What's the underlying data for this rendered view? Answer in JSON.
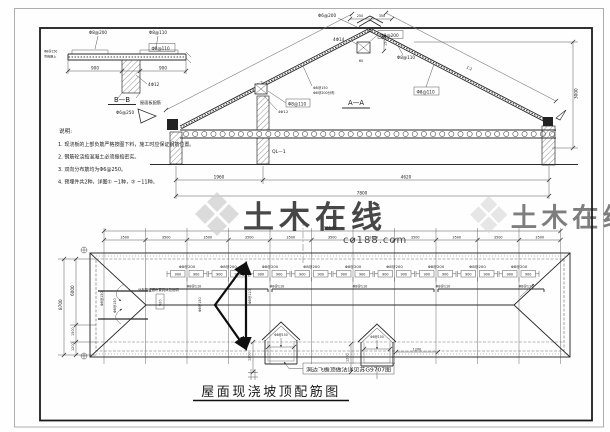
{
  "watermark": {
    "brand": "土木在线",
    "site": "co188.com"
  },
  "detail_bb": {
    "label_top_left": "Φ8@200",
    "label_top_right": "Φ8@110",
    "label_boxed": "Φ8@110",
    "label_left_1": "Φ8@150",
    "label_left_2": "弯钩朝上",
    "label_beam": "4Φ12",
    "dim_left": "900",
    "dim_right": "900",
    "title": "B—B",
    "subtitle": "屋面板配筋"
  },
  "notes": {
    "heading": "说明:",
    "items": [
      "1. 现浇板的上部负筋严格按图下料，施工时应保证钢筋位置。",
      "2. 钢筋砼浇捣混凝土必须振捣密实。",
      "3. 双向分布筋均为Φ6@250。",
      "4. 预埋件共2种，详图① ~1种，② ~11种。"
    ]
  },
  "section": {
    "title": "A—A",
    "ridge_stirrup": "Φ6@200",
    "ridge_main": "4Φ14",
    "ridge_boxed": "Φ8@200",
    "ridge_dim_a": "250",
    "ridge_dim_b": "350",
    "ridge_dim_v": "150",
    "ridge_dim_w": "60",
    "slope_left_1": "Φ8@150",
    "slope_left_2": "Φ6@200分布",
    "slope_right": "Φ8@110",
    "slope_right_boxed": "Φ8@110",
    "purlin_boxed": "Φ8@110",
    "purlin": "4Φ12",
    "eave": "Φ6@250",
    "beam": "QL—1",
    "slope_mark_left": "1:2",
    "slope_mark_right": "1:2",
    "dim_height": "3000",
    "dim_seg_1": "1960",
    "dim_seg_2": "4620",
    "dim_total": "7800"
  },
  "plan": {
    "dim_total": "38500",
    "bays": [
      "3500",
      "3500",
      "3500",
      "3500",
      "3500",
      "3500",
      "3500",
      "3500",
      "3500",
      "3500",
      "3500"
    ],
    "left_total": "8700",
    "left_d1": "6000",
    "left_d2": "1500",
    "left_d3": "1200",
    "rebar_top": "Φ8@200",
    "ext_l": "900",
    "ext_r": "900",
    "rebar_dist": "Φ8@110",
    "rot_1": "Φ8@150",
    "rot_2": "Φ8@110",
    "hip_rot_1": "Φ8@150",
    "hip_rot_2": "Φ8@150",
    "box_900": "900",
    "note_small": "分布筋连通布置具体见说明",
    "dormer_label_1": "Φ8@150",
    "dormer_label_2": "Φ8@150",
    "dim_1200_a": "1200",
    "dim_1200_b": "1200",
    "dim_1200_c": "1200",
    "callout": "洞边飞檐顶做法详见苏G9707图"
  },
  "title_block": {
    "title": "屋面现浇坡顶配筋图"
  }
}
